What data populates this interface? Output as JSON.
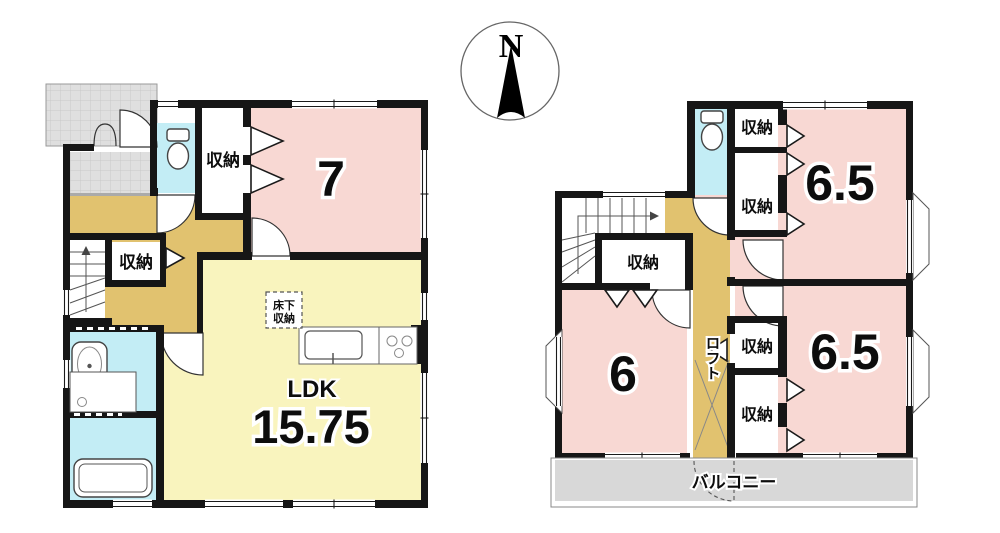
{
  "meta": {
    "type": "floor-plan",
    "floors": 2
  },
  "colors": {
    "wall": "#161616",
    "room_pink": "#f8d8d3",
    "ldk_yellow": "#f9f4be",
    "wet_cyan": "#c3edf5",
    "hall_tan": "#e1c26f",
    "tile_gray": "#dfdfdf",
    "balcony_gray": "#d8d8d8"
  },
  "compass": {
    "label": "N"
  },
  "floor1": {
    "room7": "7",
    "ldk_label": "LDK",
    "ldk_area": "15.75",
    "storage_top": "収納",
    "storage_mid": "収納",
    "underfloor_l1": "床下",
    "underfloor_l2": "収納"
  },
  "floor2": {
    "room_top_right": "6.5",
    "room_bottom_right": "6.5",
    "room_bottom_left": "6",
    "storage_top_1": "収納",
    "storage_top_2": "収納",
    "storage_stairs": "収納",
    "storage_mid_1": "収納",
    "storage_mid_2": "収納",
    "loft": "ロフト",
    "balcony": "バルコニー"
  }
}
